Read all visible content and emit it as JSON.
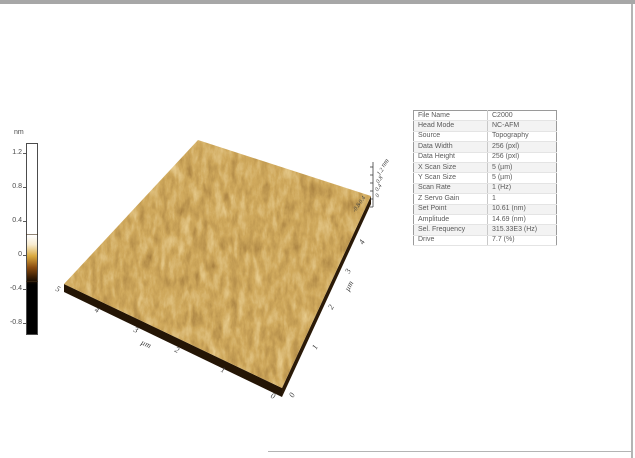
{
  "window": {
    "top_bar_color": "#a7a7a7",
    "edge_color": "#b4b4b4",
    "background": "#ffffff"
  },
  "colorbar": {
    "unit": "nm",
    "ticks": [
      "1.2",
      "0.8",
      "0.4",
      "0",
      "-0.4",
      "-0.8"
    ],
    "gradient": [
      {
        "color": "#ffffff",
        "pos": 0
      },
      {
        "color": "#ffffff",
        "pos": 48
      },
      {
        "color": "#f8ecd0",
        "pos": 53
      },
      {
        "color": "#d9a93f",
        "pos": 59
      },
      {
        "color": "#8a4c10",
        "pos": 65
      },
      {
        "color": "#3a1e04",
        "pos": 70
      },
      {
        "color": "#000000",
        "pos": 74
      },
      {
        "color": "#000000",
        "pos": 100
      }
    ]
  },
  "plot3d": {
    "type": "3d-surface-topography",
    "x_axis": {
      "unit": "µm",
      "ticks": [
        "5",
        "4",
        "3",
        "2",
        "1",
        "0"
      ],
      "range": [
        0,
        5
      ]
    },
    "y_axis": {
      "unit": "µm",
      "ticks": [
        "0",
        "1",
        "2",
        "3",
        "4"
      ],
      "range": [
        0,
        5
      ]
    },
    "z_axis": {
      "unit": "nm",
      "ticks": [
        "1.2",
        "0.8",
        "0.4",
        "0",
        "-0.4",
        "-0.8"
      ],
      "range": [
        -0.9,
        1.3
      ]
    }
  },
  "colors": {
    "chrome-top": "#a7a7a7",
    "chrome-edge": "#b4b4b4",
    "surface-base": "#8a5a22",
    "wall-left": "#241505",
    "wall-right": "#2b1a08",
    "axis-text": "#3c3c3c",
    "table-text": "#5a5a5a",
    "table-border": "#9a9a9a",
    "table-row-alt": "#f3f3f3"
  },
  "info_table": {
    "rows": [
      {
        "label": "File Name",
        "value": "C2000"
      },
      {
        "label": "Head Mode",
        "value": "NC-AFM"
      },
      {
        "label": "Source",
        "value": "Topography"
      },
      {
        "label": "Data Width",
        "value": "256 (pxl)"
      },
      {
        "label": "Data Height",
        "value": "256 (pxl)"
      },
      {
        "label": "X Scan Size",
        "value": "5 (µm)"
      },
      {
        "label": "Y Scan Size",
        "value": "5 (µm)"
      },
      {
        "label": "Scan Rate",
        "value": "1 (Hz)"
      },
      {
        "label": "Z Servo Gain",
        "value": "1"
      },
      {
        "label": "Set Point",
        "value": "10.61 (nm)"
      },
      {
        "label": "Amplitude",
        "value": "14.69 (nm)"
      },
      {
        "label": "Sel. Frequency",
        "value": "315.33E3 (Hz)"
      },
      {
        "label": "Drive",
        "value": "7.7 (%)"
      }
    ]
  }
}
